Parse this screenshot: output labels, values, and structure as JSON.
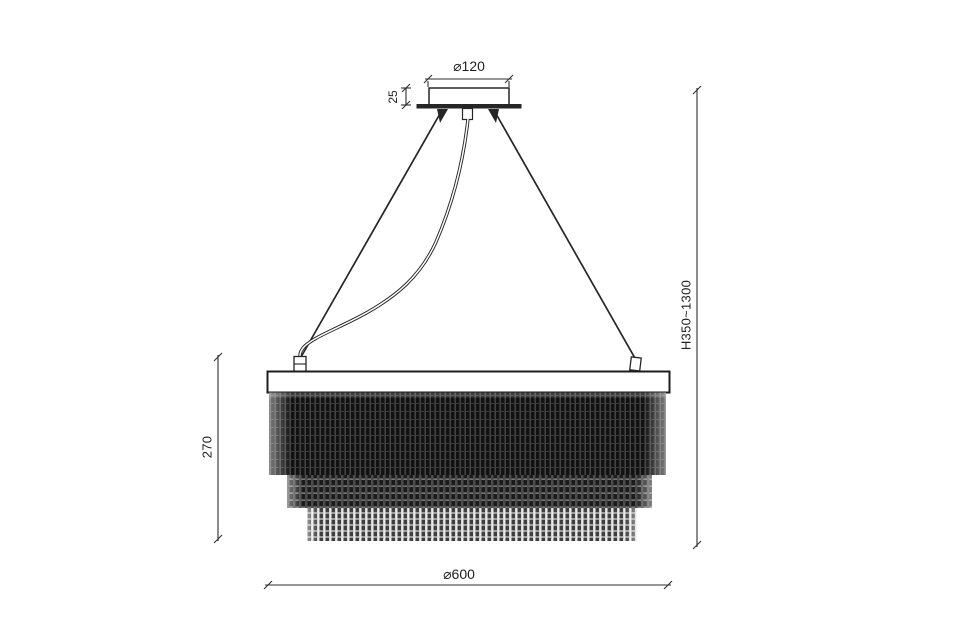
{
  "diagram": {
    "type": "chandelier dimension drawing",
    "labels": {
      "canopy_diameter": "⌀120",
      "canopy_height": "25",
      "suspension_height_range": "H350~1300",
      "body_height": "270",
      "body_diameter": "⌀600"
    },
    "colors": {
      "background": "#ffffff",
      "line": "#2b2b2b",
      "fringe_dark": "#141414",
      "fringe_mid": "#1d1d1d",
      "fringe_light": "#3f3f3f",
      "fringe_gap": "#e9e9e9"
    }
  }
}
